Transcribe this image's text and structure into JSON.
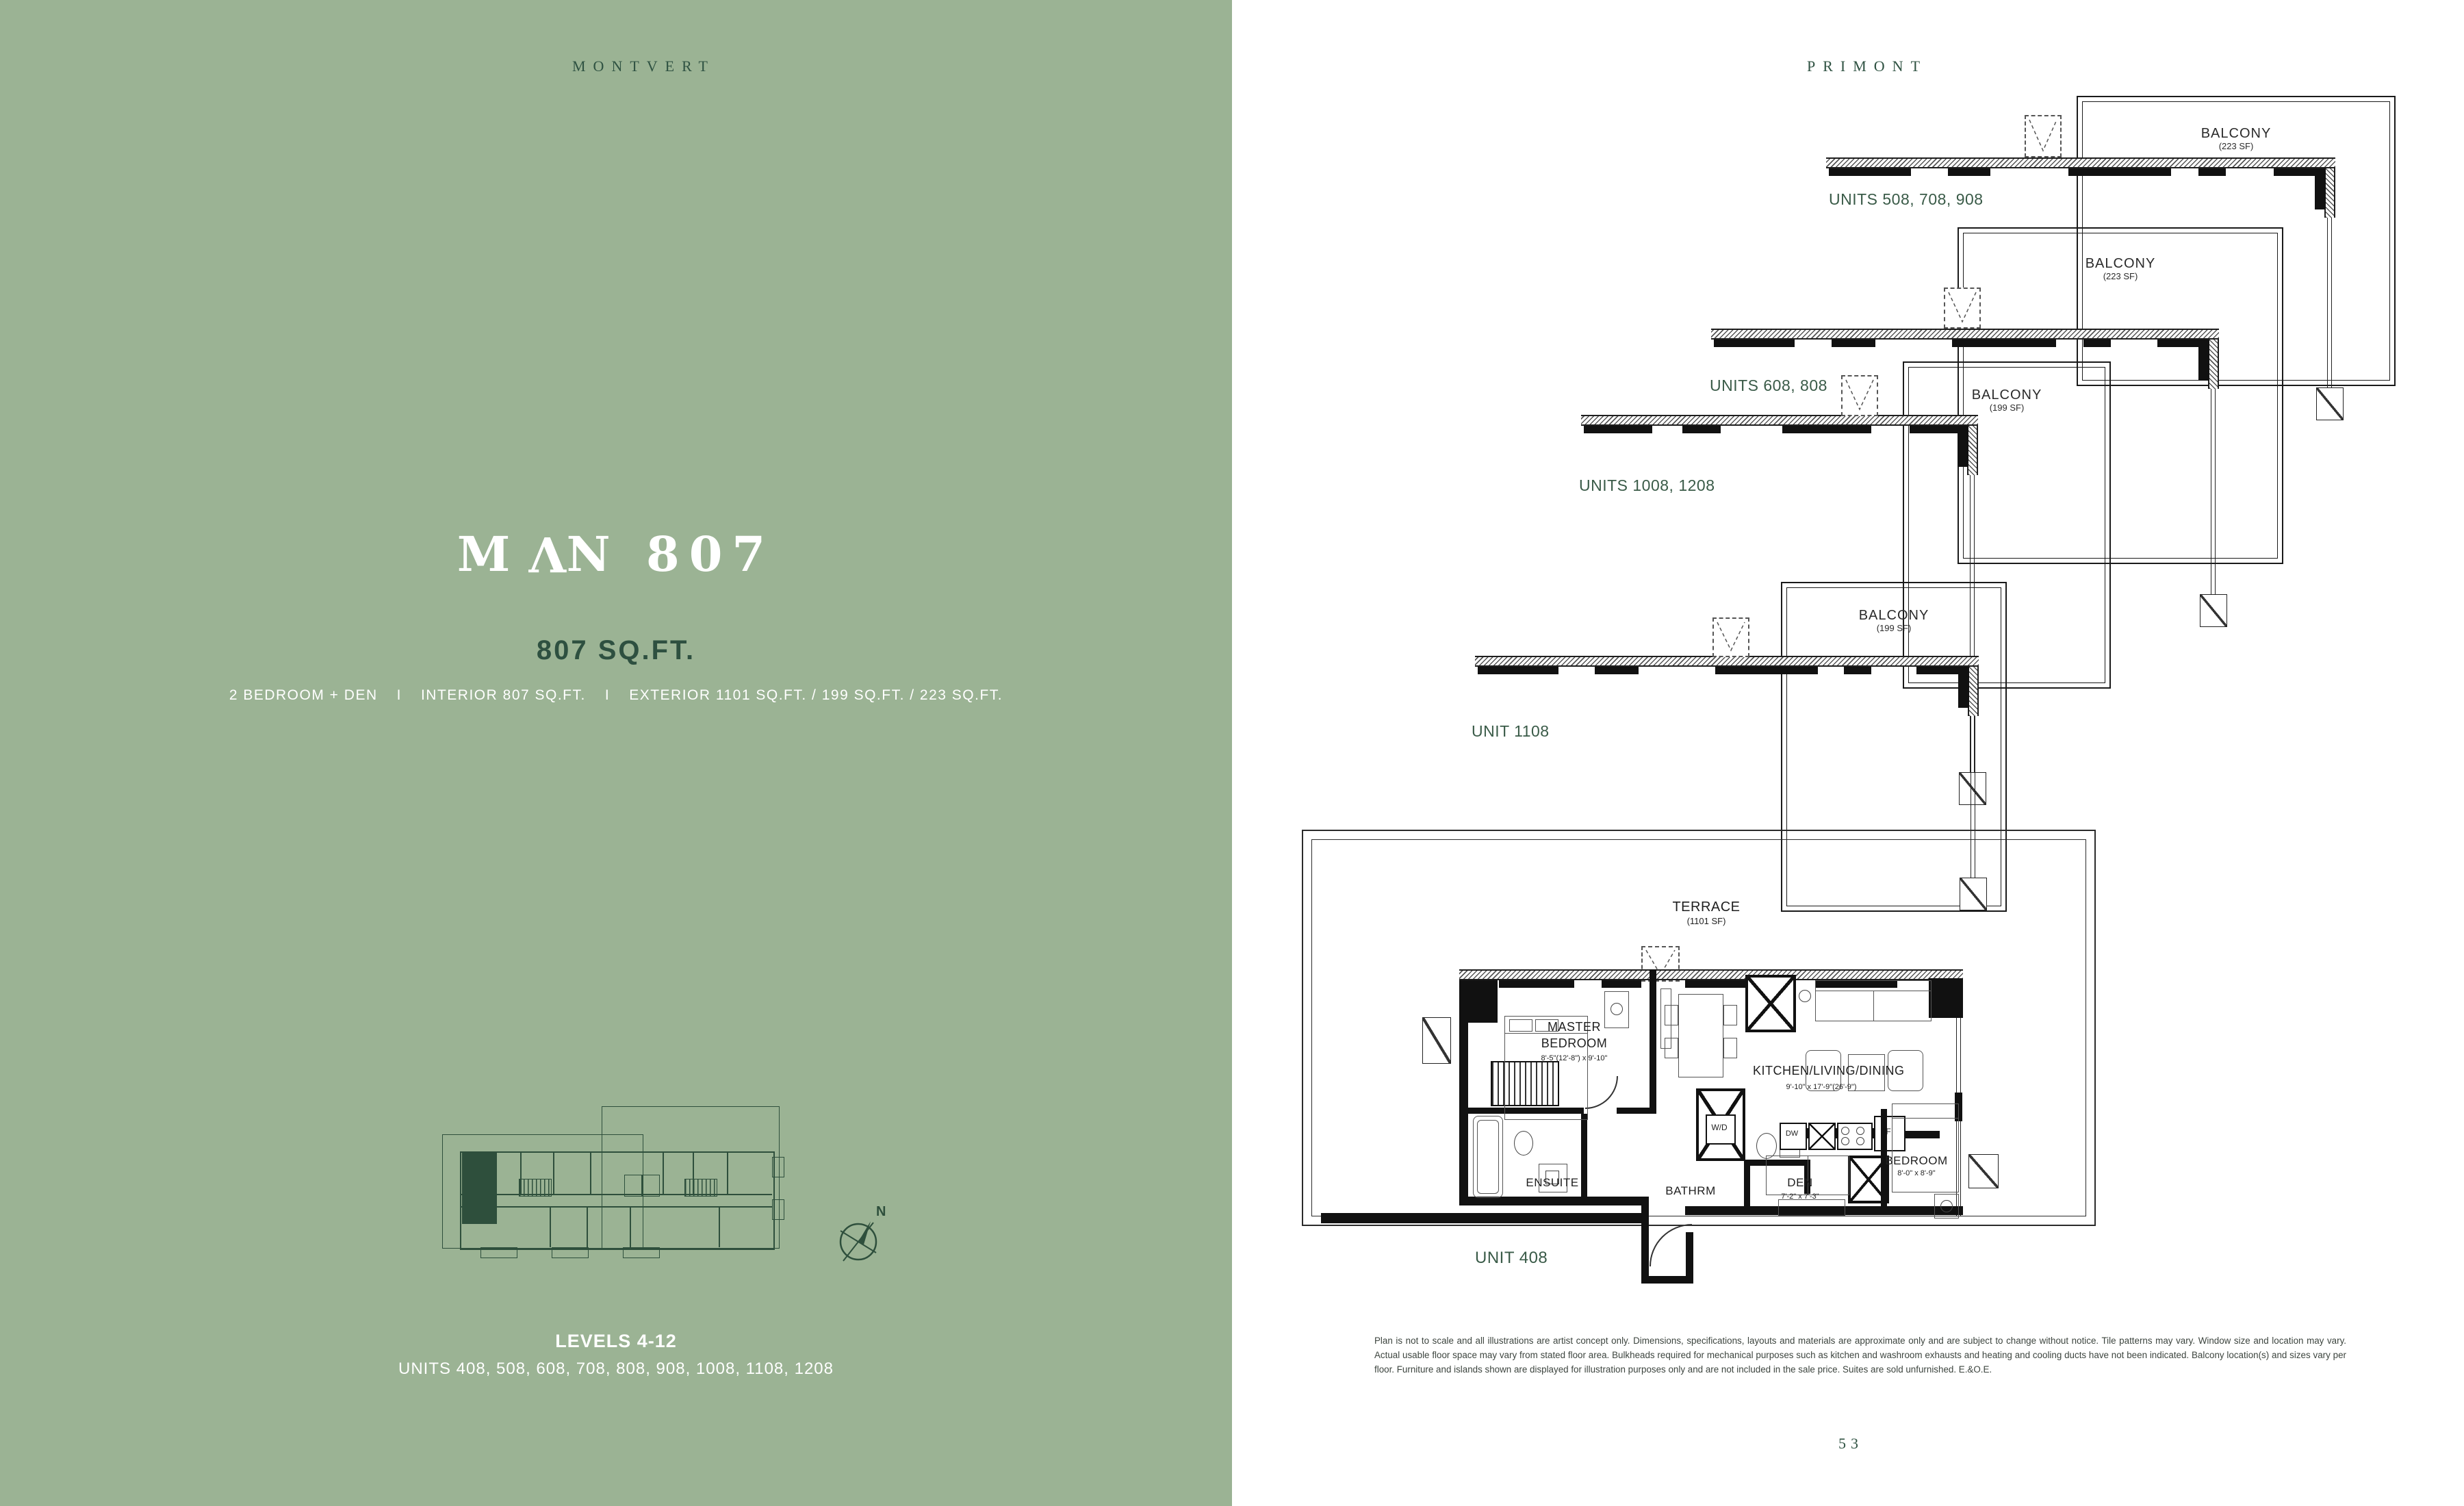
{
  "page": {
    "left_header": "MONTVERT",
    "right_header": "PRIMONT",
    "page_number": "53"
  },
  "left_panel": {
    "title_prefix": "M",
    "title_flipped": "V",
    "title_suffix": "N 807",
    "area": "807 SQ.FT.",
    "spec_bedrooms": "2 BEDROOM + DEN",
    "spec_separator": "I",
    "spec_interior": "INTERIOR 807 SQ.FT.",
    "spec_exterior": "EXTERIOR 1101 SQ.FT. / 199 SQ.FT. / 223 SQ.FT.",
    "levels": "LEVELS 4-12",
    "units_list": "UNITS 408, 508, 608, 708, 808, 908, 1008, 1108, 1208",
    "compass_n": "N"
  },
  "right_panel": {
    "mini_plans": [
      {
        "label": "UNITS 508, 708, 908",
        "balcony_label": "BALCONY",
        "balcony_area": "(223 SF)"
      },
      {
        "label": "UNITS 608, 808",
        "balcony_label": "BALCONY",
        "balcony_area": "(223 SF)"
      },
      {
        "label": "UNITS 1008, 1208",
        "balcony_label": "BALCONY",
        "balcony_area": "(199 SF)"
      },
      {
        "label": "UNIT 1108",
        "balcony_label": "BALCONY",
        "balcony_area": "(199 SF)"
      }
    ],
    "main_plan": {
      "unit_label": "UNIT 408",
      "terrace_label": "TERRACE",
      "terrace_area": "(1101 SF)",
      "master_bedroom_line1": "MASTER",
      "master_bedroom_line2": "BEDROOM",
      "master_bedroom_dim": "8'-5\"(12'-8\") x 9'-10\"",
      "kitchen_label": "KITCHEN/LIVING/DINING",
      "kitchen_dim": "9'-10\" x 17'-9\"(26'-9\")",
      "washer_dryer": "W/D",
      "dishwasher": "DW",
      "fridge": "F",
      "bathroom": "BATHRM",
      "ensuite": "ENSUITE",
      "den": "DEN",
      "den_dim": "7'-2\" x 7'-3\"",
      "bedroom": "BEDROOM",
      "bedroom_dim": "8'-0\" x 8'-9\""
    },
    "disclaimer": "Plan is not to scale and all illustrations are artist concept only. Dimensions, specifications, layouts and materials are approximate only and are subject to change without notice. Tile patterns may vary. Window size and location may vary. Actual usable floor space may vary from stated floor area. Bulkheads required for mechanical purposes such as kitchen and washroom exhausts and heating and cooling ducts have not been indicated. Balcony location(s) and sizes vary per floor. Furniture and islands shown are displayed for illustration purposes only and are not included in the sale price. Suites are sold unfurnished. E.&O.E."
  },
  "colors": {
    "panel_green": "#9BB394",
    "accent_dark_green": "#2E5040",
    "plan_line": "#1E1E1E"
  }
}
